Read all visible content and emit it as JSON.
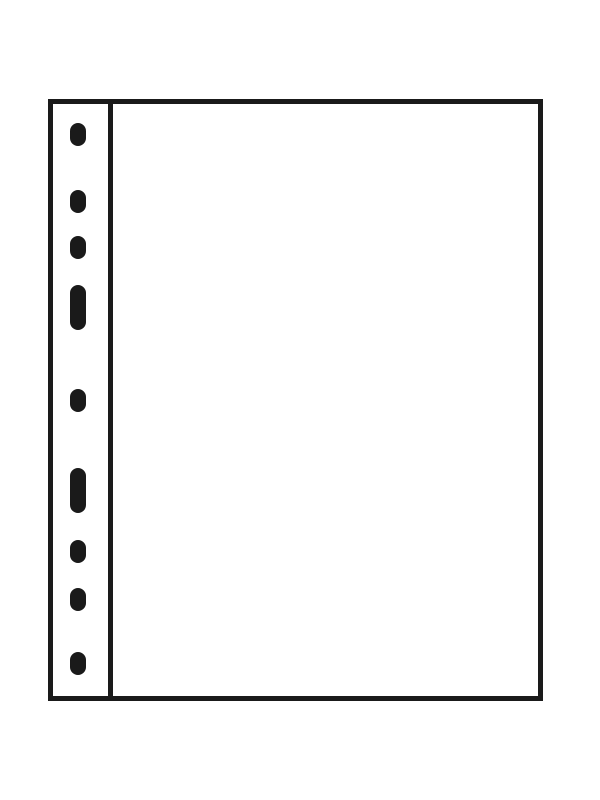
{
  "illustration": {
    "description": "Blank ring-binder album page with multi-punched binding strip",
    "colors": {
      "background": "#ffffff",
      "line": "#1a1a1a",
      "page_fill": "#ffffff"
    },
    "outline": {
      "x": 48,
      "y": 99,
      "width": 495,
      "height": 602,
      "stroke_width": 5
    },
    "divider": {
      "x": 108,
      "width": 5
    },
    "punch_strip": {
      "hole_center_x": 77.5,
      "hole_width": 16,
      "round_hole_height": 23,
      "slot_height": 45,
      "hole_count": 9,
      "holes": [
        {
          "type": "round",
          "cy": 134
        },
        {
          "type": "round",
          "cy": 201
        },
        {
          "type": "round",
          "cy": 247
        },
        {
          "type": "slot",
          "cy": 307
        },
        {
          "type": "round",
          "cy": 400
        },
        {
          "type": "slot",
          "cy": 490
        },
        {
          "type": "round",
          "cy": 551
        },
        {
          "type": "round",
          "cy": 599
        },
        {
          "type": "round",
          "cy": 663
        }
      ]
    }
  }
}
